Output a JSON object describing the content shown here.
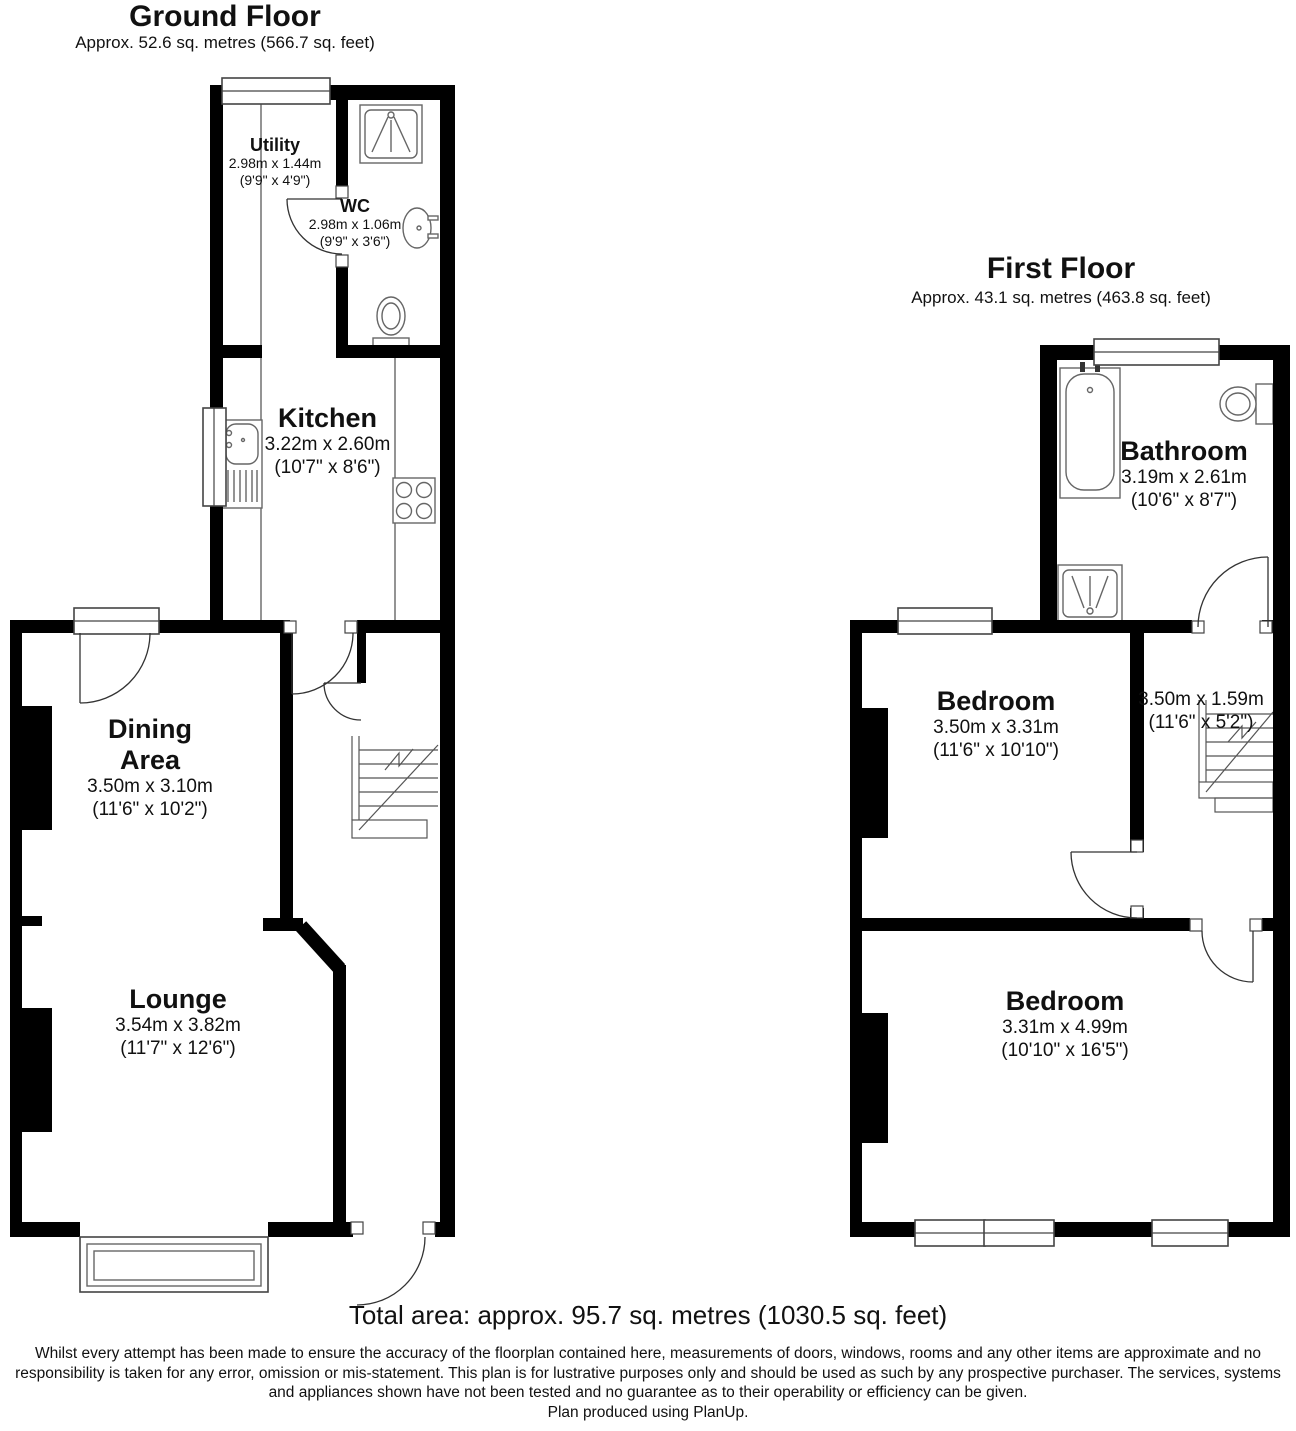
{
  "colors": {
    "wall": "#000000",
    "fixture": "#666666",
    "text": "#111111",
    "background": "#ffffff"
  },
  "ground_floor": {
    "title": "Ground Floor",
    "area": "Approx. 52.6 sq. metres (566.7 sq. feet)",
    "rooms": {
      "utility": {
        "name": "Utility",
        "metric": "2.98m x 1.44m",
        "imperial": "(9'9\" x 4'9\")"
      },
      "wc": {
        "name": "WC",
        "metric": "2.98m x 1.06m",
        "imperial": "(9'9\" x 3'6\")"
      },
      "kitchen": {
        "name": "Kitchen",
        "metric": "3.22m x 2.60m",
        "imperial": "(10'7\" x 8'6\")"
      },
      "dining_area": {
        "name_line1": "Dining",
        "name_line2": "Area",
        "metric": "3.50m x 3.10m",
        "imperial": "(11'6\" x 10'2\")"
      },
      "lounge": {
        "name": "Lounge",
        "metric": "3.54m x 3.82m",
        "imperial": "(11'7\" x 12'6\")"
      }
    }
  },
  "first_floor": {
    "title": "First Floor",
    "area": "Approx. 43.1 sq. metres (463.8 sq. feet)",
    "rooms": {
      "bathroom": {
        "name": "Bathroom",
        "metric": "3.19m x 2.61m",
        "imperial": "(10'6\" x 8'7\")"
      },
      "bedroom_front": {
        "name": "Bedroom",
        "metric": "3.50m x 3.31m",
        "imperial": "(11'6\" x 10'10\")"
      },
      "landing": {
        "metric": "3.50m x 1.59m",
        "imperial": "(11'6\" x 5'2\")"
      },
      "bedroom_rear": {
        "name": "Bedroom",
        "metric": "3.31m x 4.99m",
        "imperial": "(10'10\" x 16'5\")"
      }
    }
  },
  "footer": {
    "total_area": "Total area: approx. 95.7 sq. metres (1030.5 sq. feet)",
    "disclaimer": "Whilst every attempt has been made to ensure the accuracy of the floorplan contained here, measurements of doors, windows, rooms and any other items are approximate and no responsibility is taken for any error, omission or mis-statement. This plan is for lustrative purposes only and should be used as such by any prospective purchaser. The services, systems and appliances shown have not been tested and no guarantee as to their operability or efficiency can be given.",
    "credit": "Plan produced using PlanUp."
  }
}
